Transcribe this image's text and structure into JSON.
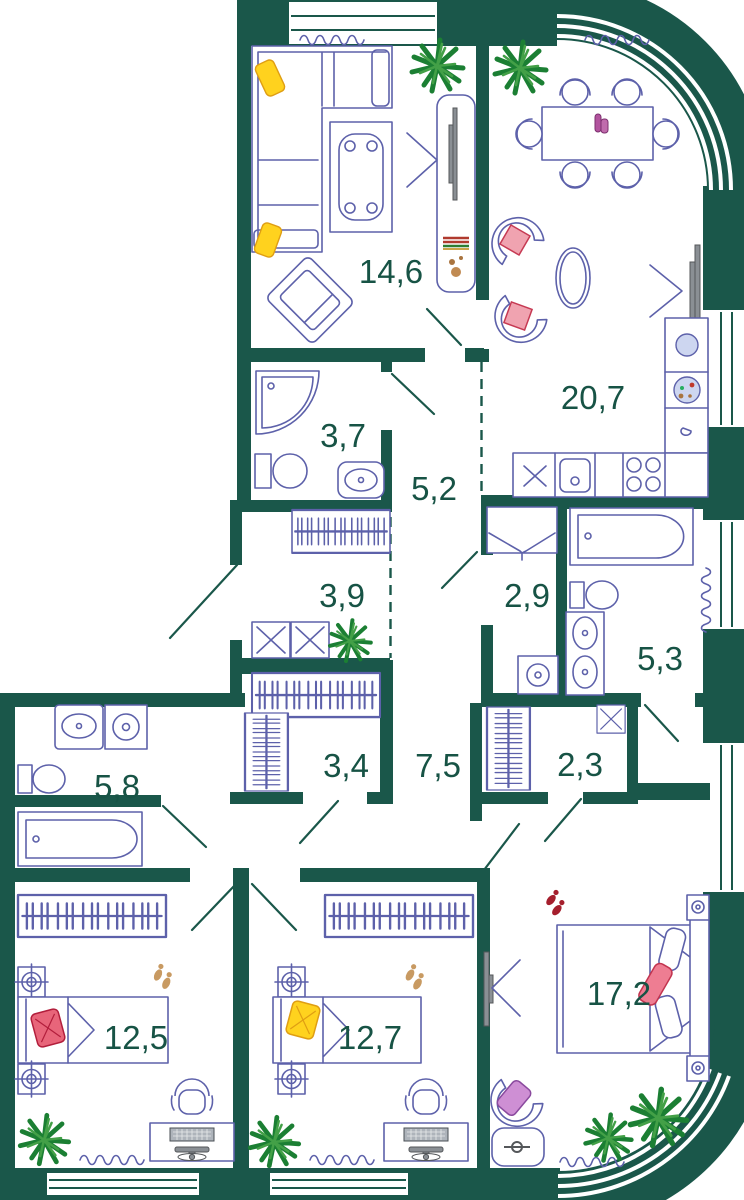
{
  "plan": {
    "type": "apartment-floor-plan",
    "colors": {
      "wall": "#1A574A",
      "furn": "#5D61AA",
      "label": "#175345",
      "plant1": "#1B7F33",
      "plant2": "#43A047",
      "tvgray": "#8A8F94",
      "pillow_yellow": "#FFD21E",
      "pillow_red": "#E8657A",
      "pillow_pink": "#F0A3B0",
      "pillow_purple": "#CE8FD4",
      "vase": "#B2539E",
      "slipper_tan": "#C89A62",
      "slipper_red": "#A51F2D"
    },
    "rooms": [
      {
        "name": "living-room",
        "area": "14,6"
      },
      {
        "name": "kitchen-dining",
        "area": "20,7"
      },
      {
        "name": "shower-room",
        "area": "3,7"
      },
      {
        "name": "hallway",
        "area": "5,2"
      },
      {
        "name": "entry-hall",
        "area": "3,9"
      },
      {
        "name": "laundry",
        "area": "2,9"
      },
      {
        "name": "bathroom",
        "area": "5,3"
      },
      {
        "name": "corridor",
        "area": "7,5"
      },
      {
        "name": "walk-in-closet",
        "area": "3,4"
      },
      {
        "name": "closet",
        "area": "2,3"
      },
      {
        "name": "master-bathroom",
        "area": "5,8"
      },
      {
        "name": "bedroom-1",
        "area": "12,5"
      },
      {
        "name": "bedroom-2",
        "area": "12,7"
      },
      {
        "name": "master-bedroom",
        "area": "17,2"
      }
    ]
  }
}
